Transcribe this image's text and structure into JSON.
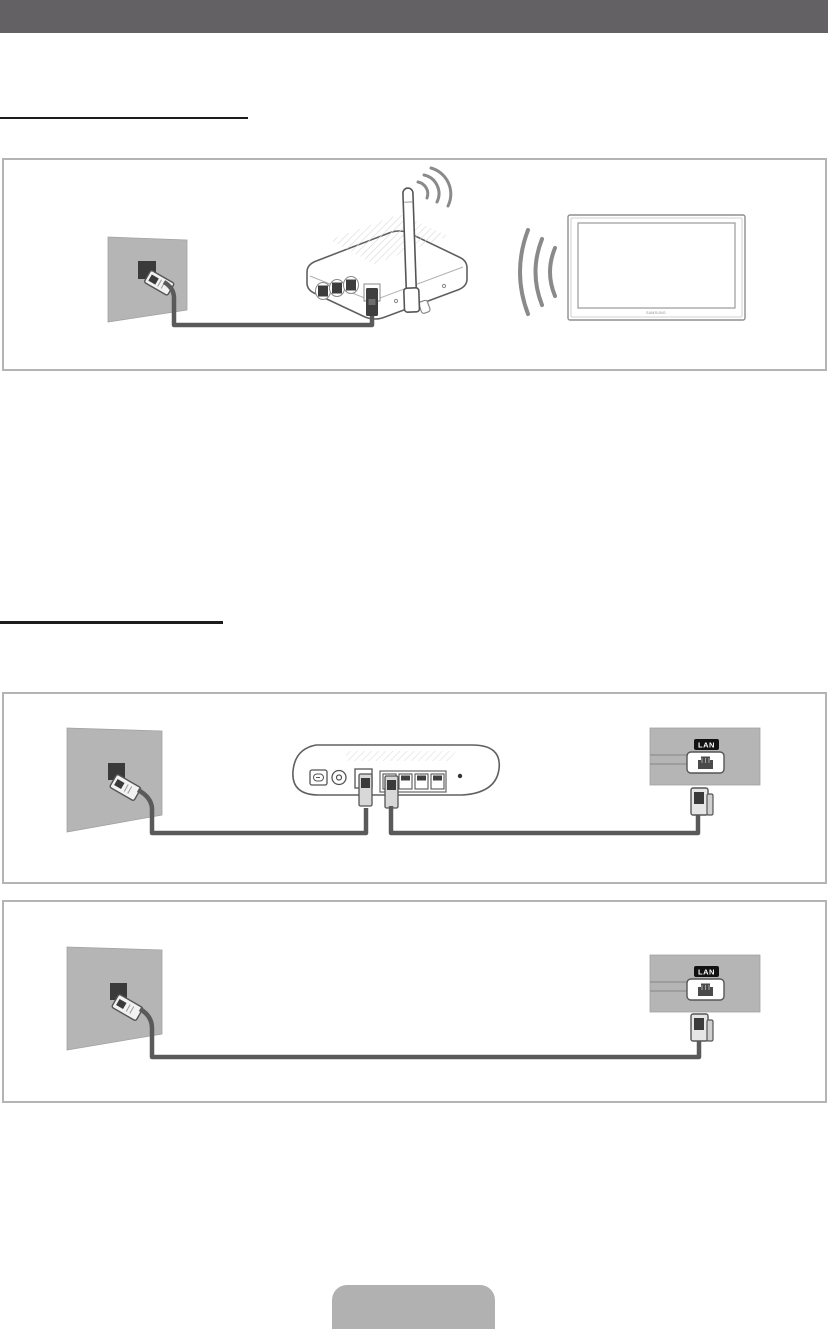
{
  "titlebar": {
    "color": "#636163"
  },
  "diagram_wireless": {
    "tv_logo": "SAMSUNG"
  },
  "diagram_modem": {
    "lan_badge": "LAN"
  },
  "diagram_direct": {
    "lan_badge": "LAN"
  },
  "colors": {
    "wall_gray": "#b5b5b5",
    "panel_gray": "#b5b5b5",
    "cable": "#5a5a5a",
    "port_dark": "#3a3a3a",
    "device_outline": "#606060",
    "box_border": "#b4b4b4",
    "underline": "#1c1c1c",
    "badge_bg": "#111111",
    "badge_text": "#ffffff",
    "footer_button": "#b1b1b1",
    "wave_gray": "#8a8a8a"
  }
}
